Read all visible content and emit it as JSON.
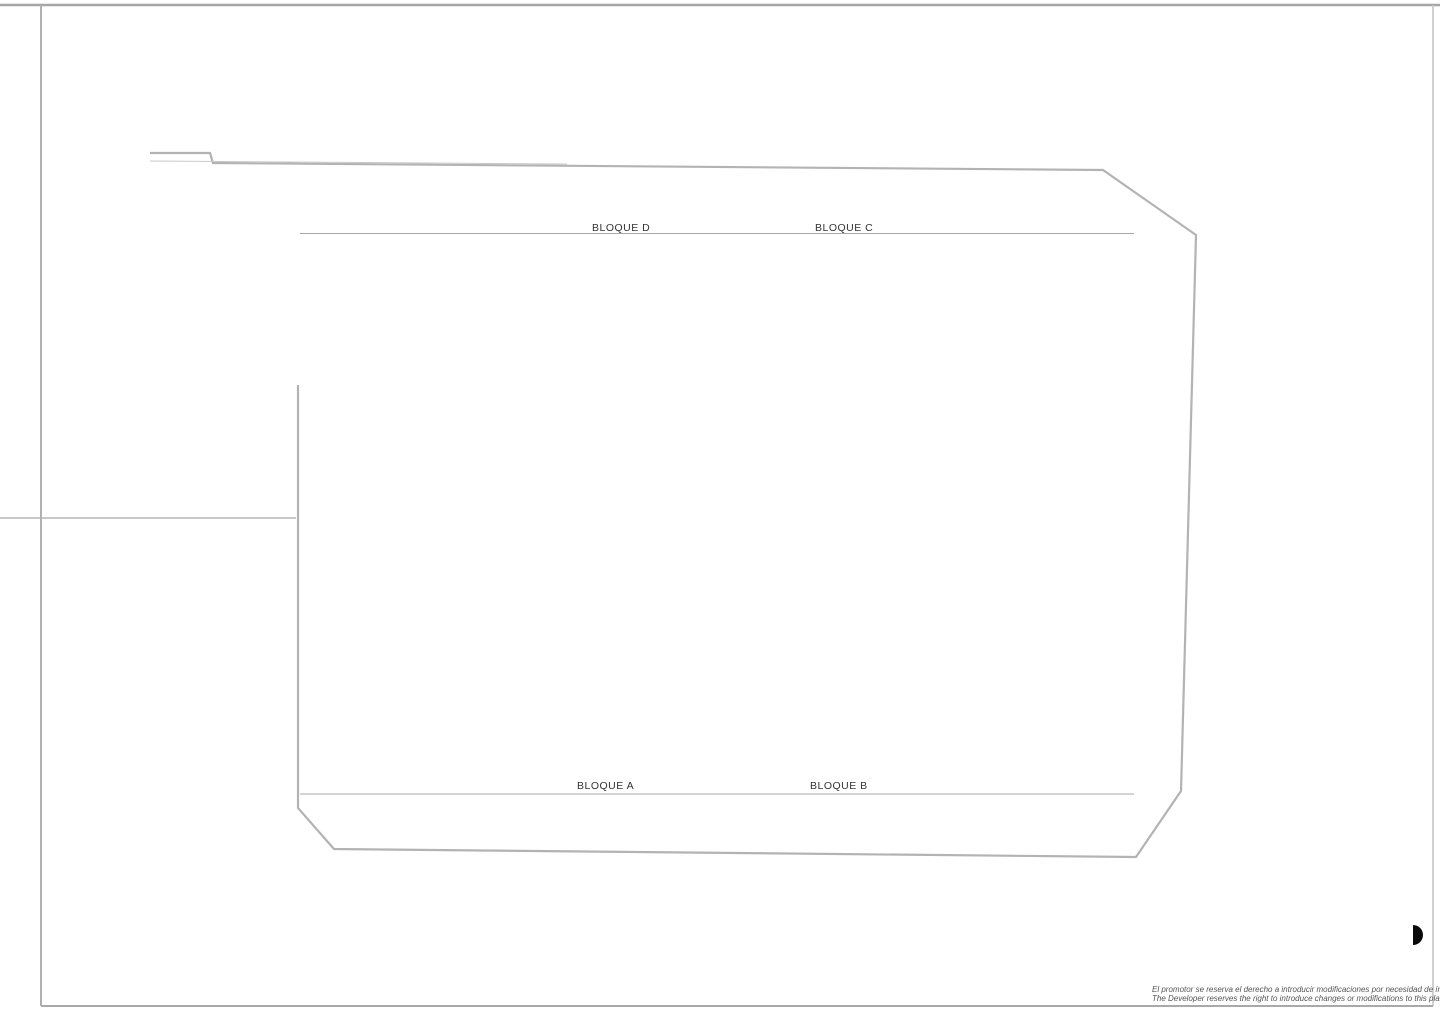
{
  "plan": {
    "blocks": {
      "d": "BLOQUE D",
      "c": "BLOQUE C",
      "a": "BLOQUE A",
      "b": "BLOQUE B"
    },
    "parking": {
      "top_left": [
        "P72",
        "P71",
        "P70",
        "P69",
        "P68",
        "P67",
        "P66",
        "P65",
        "P64",
        "P63",
        "P62",
        "P61"
      ],
      "top_left_accessible": "P60",
      "top_mid_left": [
        "P59",
        "P58",
        "P57",
        "P56",
        "P55"
      ],
      "top_mid_right": [
        "P54",
        "P53",
        "P52",
        "P51"
      ],
      "top_right": [
        "P50",
        "P49",
        "P48",
        "P47",
        "P46",
        "P45",
        "P44",
        "P43",
        "P42",
        "P41",
        "P40"
      ],
      "right_column_upper": [
        "P39",
        "P38",
        "P37",
        "P36",
        "P35"
      ],
      "right_column_lower": [
        "P34",
        "P33",
        "P32",
        "P31",
        "P30"
      ],
      "bottom_left": [
        "P1",
        "P2",
        "P3",
        "P4",
        "P5",
        "P6",
        "P7",
        "P8",
        "P9",
        "P10"
      ],
      "bottom_mid_left": [
        "P11",
        "P12",
        "P13",
        "P14",
        "P15"
      ],
      "bottom_accessible": "P16",
      "bottom_mid_right": [
        "P17",
        "P18",
        "P19"
      ],
      "bottom_right": [
        "P20",
        "P21",
        "P22",
        "P23",
        "P24",
        "P25",
        "P26",
        "P27",
        "P28",
        "P29"
      ]
    },
    "unit_numbers": {
      "top_row": [
        "55",
        "56",
        "57",
        "58",
        "59",
        "60",
        "42",
        "41",
        "40",
        "39",
        "38",
        "37"
      ],
      "bottom_row": [
        "1",
        "2",
        "3",
        "4",
        "5",
        "6",
        "24",
        "23",
        "22",
        "21",
        "20",
        "19"
      ]
    },
    "disclaimer": {
      "line1": "El promotor se reserva el derecho a introducir modificaciones por necesidad de índole técnica o lega",
      "line2": "The Developer reserves the right to introduce changes or modifications to this plan due to legal or tec"
    },
    "colors": {
      "walkway_pink": "#f5b1a6",
      "walkway_pink_edge": "#e09488",
      "deck_tan": "#f8ddb2",
      "deck_tan_edge": "#d9b98a",
      "pool_blue_light": "#b7cce8",
      "pool_blue_dark": "#8aabd6",
      "parking_gray": "#c8c8c8",
      "accent_green": "#33a02c",
      "bench_red": "#bf5a4e"
    }
  }
}
